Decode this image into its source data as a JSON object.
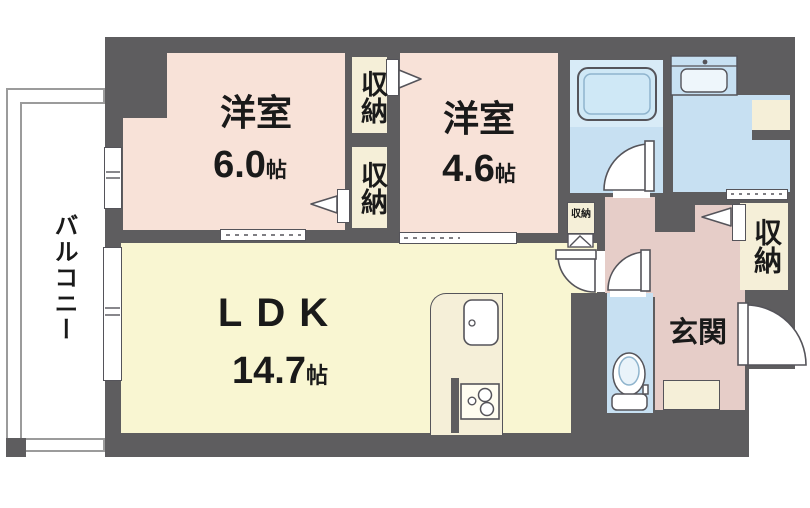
{
  "floorplan": {
    "title": "1LDK+2室 マンション間取り図",
    "balcony": {
      "label": "バルコニー"
    },
    "bedroom1": {
      "name": "洋室",
      "size": "6.0",
      "unit": "帖"
    },
    "bedroom2": {
      "name": "洋室",
      "size": "4.6",
      "unit": "帖"
    },
    "ldk": {
      "name": "LDK",
      "size": "14.7",
      "unit": "帖"
    },
    "genkan": {
      "label": "玄関"
    },
    "closets": {
      "between_top": "収納",
      "between_bottom": "収納",
      "hall_small": "収納",
      "entrance_side": "収納"
    },
    "fixtures": {
      "bathtub": "bathtub",
      "wash_basin": "wash-basin",
      "toilet": "toilet",
      "kitchen_sink": "kitchen-sink",
      "stove": "gas-stove"
    },
    "colors": {
      "wall": "#5e5d5f",
      "bedroom": "#f8e2d8",
      "ldk": "#f9f6d2",
      "closet": "#f5efd8",
      "wet_area": "#c7e0f2",
      "bath_upper": "#d8ebf7",
      "entrance": "#e6cdc8",
      "balcony_line": "#9b9b9b"
    }
  }
}
